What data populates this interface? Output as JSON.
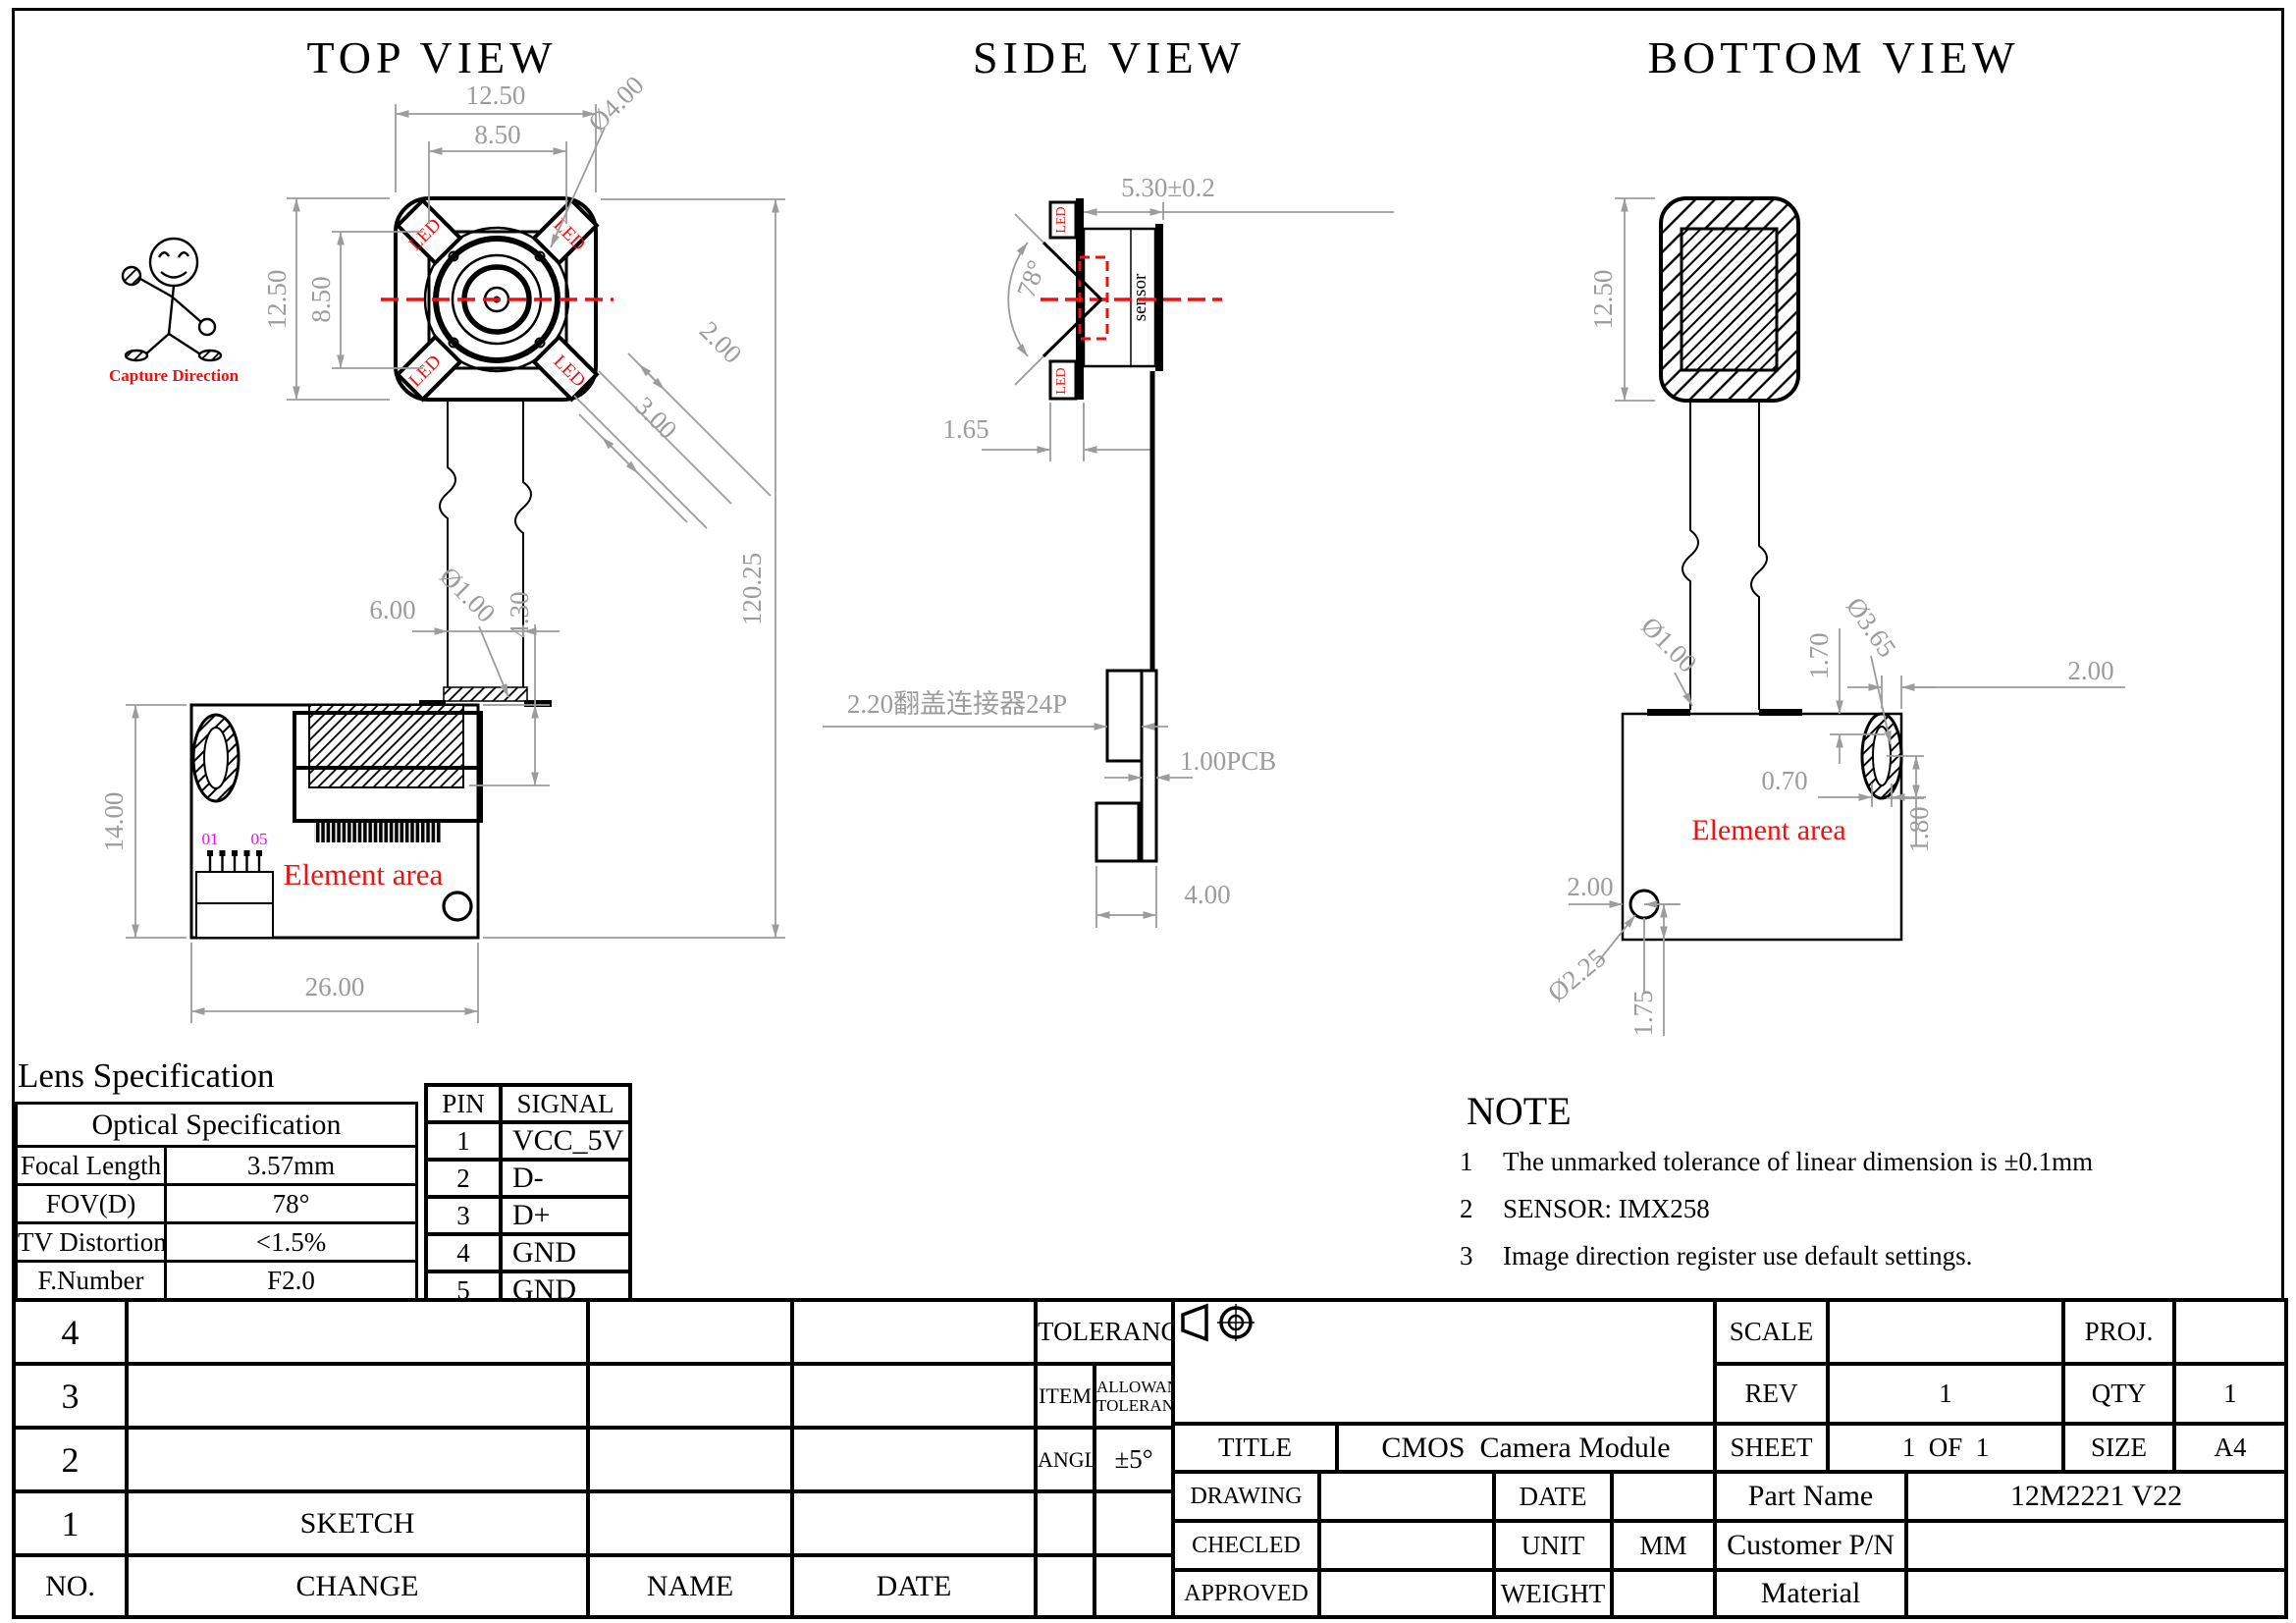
{
  "views": {
    "top": {
      "title": "TOP VIEW",
      "capture_direction": "Capture Direction",
      "led": "LED",
      "element_area": "Element area",
      "pin_first": "01",
      "pin_last": "05",
      "dims": {
        "body_w": "12.50",
        "body_face_w": "8.50",
        "body_h": "12.50",
        "body_face_h": "8.50",
        "lens_dia": "Ø4.00",
        "led_w": "2.00",
        "led_l": "3.00",
        "cable_w": "6.00",
        "cable_t": "Ø1.00",
        "conn_h": "4.30",
        "total_len": "120.25",
        "pcb_h": "14.00",
        "pcb_w": "26.00"
      }
    },
    "side": {
      "title": "SIDE VIEW",
      "sensor": "sensor",
      "led": "LED",
      "dims": {
        "height": "5.30±0.2",
        "fov": "78°",
        "led_t": "1.65",
        "connector": "2.20翻盖连接器24P",
        "pcb": "1.00PCB",
        "conn_w": "4.00"
      }
    },
    "bottom": {
      "title": "BOTTOM VIEW",
      "element_area": "Element area",
      "dims": {
        "body_h": "12.50",
        "cable_t": "Ø1.00",
        "hole_top": "1.70",
        "hole_dia": "Ø3.65",
        "hole_right": "2.00",
        "hole_w": "0.70",
        "hole_h": "1.80",
        "hole2_left": "2.00",
        "hole2_dia": "Ø2.25",
        "hole2_bottom": "1.75"
      }
    }
  },
  "lens_spec": {
    "title": "Lens Specification",
    "header": "Optical Specification",
    "rows": [
      {
        "label": "Focal Length",
        "value": "3.57mm"
      },
      {
        "label": "FOV(D)",
        "value": "78°"
      },
      {
        "label": "TV Distortion",
        "value": "<1.5%"
      },
      {
        "label": "F.Number",
        "value": "F2.0"
      }
    ]
  },
  "pin_table": {
    "headers": [
      "PIN",
      "SIGNAL"
    ],
    "rows": [
      [
        "1",
        "VCC_5V"
      ],
      [
        "2",
        "D-"
      ],
      [
        "3",
        "D+"
      ],
      [
        "4",
        "GND"
      ],
      [
        "5",
        "GND"
      ]
    ]
  },
  "note": {
    "title": "NOTE",
    "items": [
      {
        "no": "1",
        "text": "The unmarked tolerance of linear dimension is ±0.1mm"
      },
      {
        "no": "2",
        "text": "SENSOR: IMX258"
      },
      {
        "no": "3",
        "text": "Image direction register use default settings."
      }
    ]
  },
  "revision_table": {
    "row_numbers": [
      "4",
      "3",
      "2",
      "1"
    ],
    "sketch": "SKETCH",
    "footer": {
      "no": "NO.",
      "change": "CHANGE",
      "name": "NAME",
      "date": "DATE"
    }
  },
  "tolerance_table": {
    "title": "TOLERANCE",
    "item": "ITEM",
    "allowance_line1": "ALLOWANCE",
    "allowance_line2": "TOLERANCE",
    "angle": "ANGLE",
    "angle_value": "±5°"
  },
  "title_block": {
    "scale_label": "SCALE",
    "scale_value": "",
    "proj_label": "PROJ.",
    "rev_label": "REV",
    "rev_value": "1",
    "qty_label": "QTY",
    "qty_value": "1",
    "title_label": "TITLE",
    "title_value": "CMOS  Camera Module",
    "sheet_label": "SHEET",
    "sheet_value": "1  OF  1",
    "size_label": "SIZE",
    "size_value": "A4",
    "drawing_label": "DRAWING",
    "date_label": "DATE",
    "part_name_label": "Part Name",
    "part_name_value": "12M2221 V22",
    "checked_label": "CHECLED",
    "unit_label": "UNIT",
    "unit_value": "MM",
    "customer_pn_label": "Customer P/N",
    "approved_label": "APPROVED",
    "weight_label": "WEIGHT",
    "material_label": "Material"
  },
  "colors": {
    "dimension": "#9c9c9c",
    "accent_red": "#ee1111",
    "pin_label_magenta": "#ff00ff",
    "line_black": "#000000"
  }
}
